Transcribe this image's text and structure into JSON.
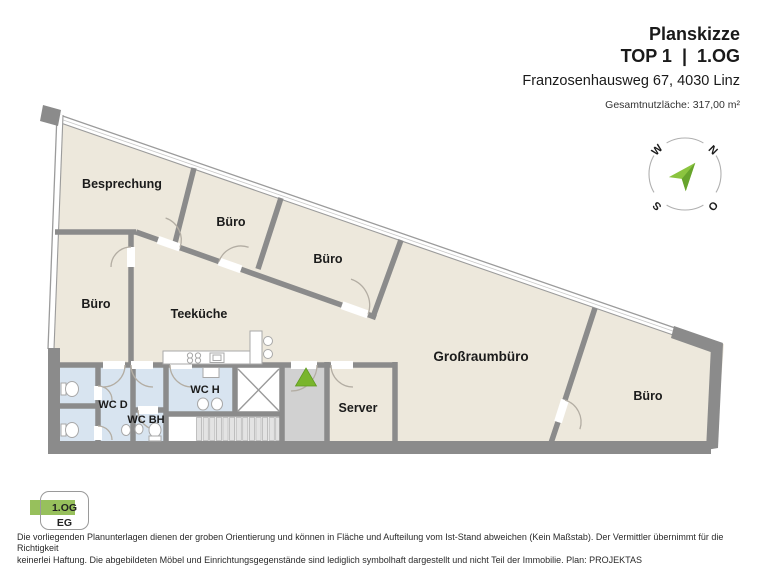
{
  "header": {
    "title": "Planskizze",
    "unit_line": "TOP 1  |  1.OG",
    "address": "Franzosenhausweg 67, 4030 Linz",
    "area_label": "Gesamtnutzläche: 317,00 m²"
  },
  "compass": {
    "n": "N",
    "o": "O",
    "s": "S",
    "w": "W"
  },
  "rooms": {
    "besprechung": "Besprechung",
    "buero_1": "Büro",
    "buero_2": "Büro",
    "buero_3": "Büro",
    "teekueche": "Teeküche",
    "wc_d": "WC D",
    "wc_bh": "WC BH",
    "wc_h": "WC H",
    "server": "Server",
    "grossraumbuero": "Großraumbüro",
    "buero_4": "Büro"
  },
  "floor_selector": {
    "current": "1.OG",
    "other": "EG",
    "highlight_color": "#97c05c"
  },
  "disclaimer": {
    "line1": "Die vorliegenden Planunterlagen dienen der groben Orientierung und können in Fläche und Aufteilung vom Ist-Stand abweichen (Kein Maßstab). Der Vermittler übernimmt für die Richtigkeit",
    "line2": "keinerlei Haftung. Die abgebildeten Möbel und Einrichtungsgegenstände sind lediglich symbolhaft dargestellt und nicht Teil der Immobilie. Plan: PROJEKTAS"
  },
  "colors": {
    "floor_beige": "#ede8dc",
    "wc_blue": "#d8e4f0",
    "hall_gray": "#d1d1d1",
    "wall_gray": "#8b8b8b",
    "accent_green": "#79b52c"
  }
}
